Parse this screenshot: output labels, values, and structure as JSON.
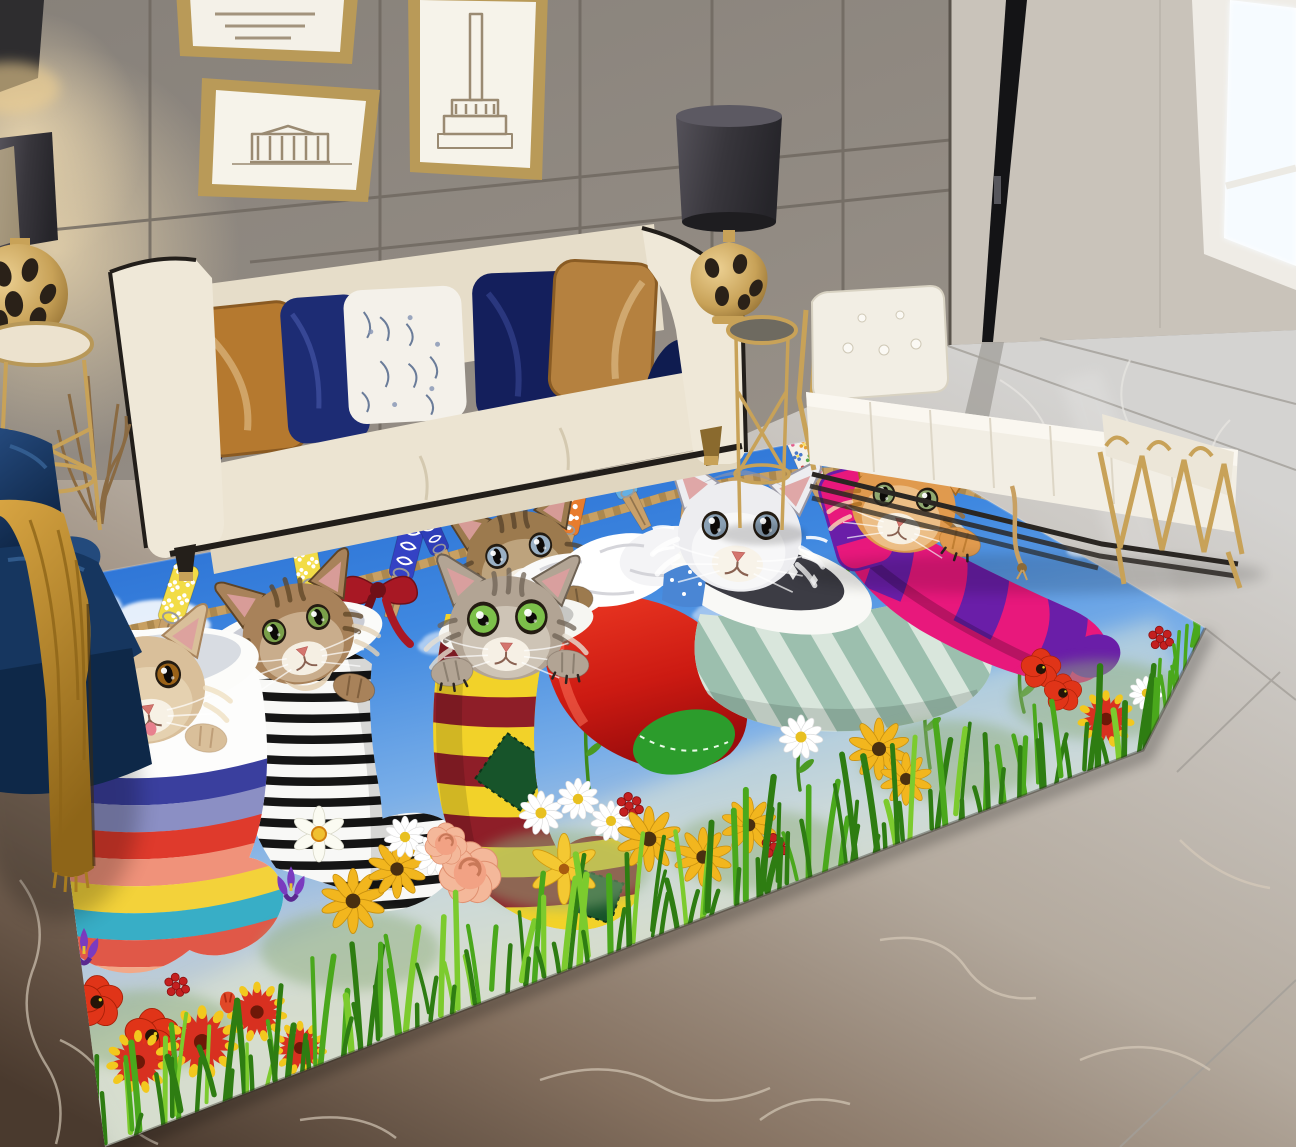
{
  "scene": {
    "label": "Living room product photo: colorful area rug printed with six kittens peeking from stockings hung on a clothesline above a flower meadow; cream sofa with pillows, navy armchair with mustard throw, white daybed bench with gold legs, gold side tables with dark drum lamps, gray panel wall with gold picture frames, bright window, two-tone marble floor",
    "domain": "Natural-Image"
  },
  "palette": {
    "wall": "#8e8780",
    "wallSeam": "#6e675f",
    "wallRight": "#c9c3ba",
    "window": "#fdfdfa",
    "gold": "#c8a258",
    "goldDark": "#8a6a2e",
    "sofaCream": "#efe8d8",
    "sofaCream2": "#e6ddc9",
    "trim": "#221e1a",
    "pillowCaramel": "#b5792f",
    "pillowNavy": "#18266e",
    "benchWhite": "#f2eee4",
    "chairNavy": "#16365f",
    "throwMustard": "#c08b2c",
    "marbleLight": "#cecdca",
    "marbleBrown": "#6b5847",
    "marbleDark": "#3f3128",
    "skyTop": "#1a5ecb",
    "skyLow": "#ccd2c6",
    "rope": "#c8a062",
    "ropeDark": "#8a6a38",
    "grassDark": "#2e7d12",
    "grassMid": "#4aa81c",
    "grassLight": "#7ccb2e"
  },
  "rug": {
    "outline": [
      [
        32,
        585
      ],
      [
        868,
        430
      ],
      [
        1205,
        628
      ],
      [
        1143,
        750
      ],
      [
        105,
        1147
      ]
    ],
    "clouds": [
      [
        160,
        618,
        46,
        0.95
      ],
      [
        300,
        482,
        40,
        0.9
      ],
      [
        368,
        516,
        26,
        0.85
      ],
      [
        532,
        572,
        34,
        1
      ],
      [
        645,
        458,
        48,
        0.9
      ],
      [
        770,
        562,
        20,
        0.8
      ],
      [
        988,
        444,
        44,
        0.9
      ],
      [
        1064,
        465,
        26,
        0.85
      ],
      [
        205,
        702,
        24,
        0.8
      ],
      [
        98,
        602,
        22,
        0.8
      ],
      [
        452,
        642,
        30,
        0.6
      ],
      [
        722,
        612,
        26,
        0.5
      ],
      [
        908,
        560,
        18,
        0.6
      ],
      [
        1092,
        548,
        22,
        0.7
      ]
    ],
    "pins": [
      {
        "x": 172,
        "y": 614,
        "rot": 18,
        "s": 1,
        "color": "#f2dc46",
        "pattern": "floral-white"
      },
      {
        "x": 310,
        "y": 580,
        "rot": -10,
        "s": 0.95,
        "color": "#f2dc46",
        "pattern": "floral-white"
      },
      {
        "x": 402,
        "y": 570,
        "rot": 14,
        "s": 0.95,
        "color": "#3442c4",
        "pattern": "swirl-white"
      },
      {
        "x": 438,
        "y": 546,
        "rot": -24,
        "s": 0.78,
        "color": "#2e3eb8",
        "pattern": "swirl-white"
      },
      {
        "x": 568,
        "y": 526,
        "rot": 12,
        "s": 0.9,
        "color": "#e87c2e",
        "pattern": "speckle-white"
      },
      {
        "x": 626,
        "y": 489,
        "rot": -28,
        "s": 0.85,
        "color": "#64b0e4",
        "pattern": "swirl-white"
      },
      {
        "x": 692,
        "y": 479,
        "rot": 10,
        "s": 0.78,
        "color": "#3850c8",
        "pattern": "diamond-white"
      },
      {
        "x": 812,
        "y": 474,
        "rot": -24,
        "s": 0.82,
        "color": "#f4f1ea",
        "pattern": "floral-multi"
      },
      {
        "x": 884,
        "y": 494,
        "rot": 6,
        "s": 0.68,
        "color": "#f0cdd8",
        "pattern": "floral-multi"
      }
    ],
    "bow": {
      "x": 378,
      "y": 588,
      "color": "#a81824",
      "dark": "#701018"
    },
    "rainbow": [
      "#3a3f9e",
      "#8b8fc4",
      "#df3a2c",
      "#f0927a",
      "#f3d23a",
      "#38aec6",
      "#e05848",
      "#f2a888",
      "#f3d23a"
    ],
    "ymColors": [
      "#f2d229",
      "#8e1e28"
    ],
    "sageStripe": "#9cbfae",
    "sageBase": "#d9e6dc",
    "pinkTube": {
      "base": "#e8187c",
      "ring": "#6a1ea8"
    },
    "santaRed": [
      "#e83020",
      "#a80e0e"
    ],
    "santaToe": "#2c9c2c",
    "cats": [
      {
        "x": 145,
        "y": 688,
        "r": 62,
        "rot": -8,
        "fur": "#d9bf9a",
        "light": "#efe0c2",
        "dark": "#a8845c",
        "eye": "#9a6218",
        "tongue": true,
        "paws": [
          [
            78,
            744,
            -14
          ],
          [
            206,
            738,
            10
          ]
        ],
        "pawClaws": false
      },
      {
        "x": 298,
        "y": 632,
        "r": 58,
        "rot": -14,
        "fur": "#a8825a",
        "light": "#e4d2b6",
        "dark": "#5e4426",
        "eye": "#7aa04a",
        "tabby": true,
        "chest": true,
        "paws": [
          [
            354,
            688,
            14
          ]
        ]
      },
      {
        "x": 520,
        "y": 558,
        "r": 56,
        "rot": -10,
        "fur": "#9c7a4e",
        "light": "#d8c4a4",
        "dark": "#55412a",
        "eye": "#9ab0c4",
        "tabby": true
      },
      {
        "x": 507,
        "y": 626,
        "r": 60,
        "rot": 2,
        "fur": "#b2a494",
        "light": "#e6ded2",
        "dark": "#6e6254",
        "eye": "#7cc04a",
        "tabby": true,
        "bigEyes": true,
        "paws": [
          [
            452,
            672,
            -8
          ],
          [
            568,
            664,
            6
          ]
        ],
        "pawClaws": true
      },
      {
        "x": 740,
        "y": 534,
        "r": 64,
        "rot": 5,
        "fur": "#ededf0",
        "light": "#ffffff",
        "dark": "#9a98a4",
        "eye": "#8aa0b4",
        "fluffy": true
      },
      {
        "x": 904,
        "y": 504,
        "r": 54,
        "rot": 12,
        "fur": "#e09a4e",
        "light": "#f6ddb5",
        "dark": "#a86a1e",
        "eye": "#90a870",
        "tabby": true,
        "paws": [
          [
            960,
            542,
            18
          ]
        ],
        "pawClaws": true
      }
    ],
    "flowers": [
      [
        "pinkcluster",
        40,
        656,
        0.8
      ],
      [
        "pinkcluster",
        28,
        692,
        0.7
      ],
      [
        "iris",
        84,
        952,
        1.0
      ],
      [
        "poppy",
        97,
        1002,
        1.1
      ],
      [
        "poppy",
        152,
        1036,
        1.15
      ],
      [
        "redcluster",
        176,
        986,
        0.8
      ],
      [
        "gaillardia",
        202,
        1042,
        1.15
      ],
      [
        "gaillardia",
        257,
        1012,
        0.95
      ],
      [
        "gaillardia",
        138,
        1062,
        1.0
      ],
      [
        "gaillardia",
        300,
        1048,
        0.85
      ],
      [
        "iris",
        291,
        889,
        0.95
      ],
      [
        "daffodil",
        319,
        834,
        1.0
      ],
      [
        "susan",
        353,
        901,
        1.05
      ],
      [
        "susan",
        397,
        869,
        0.95
      ],
      [
        "daisy",
        405,
        837,
        0.8
      ],
      [
        "daisy",
        435,
        855,
        0.8
      ],
      [
        "rose",
        470,
        873,
        1.25
      ],
      [
        "rose",
        446,
        844,
        0.85
      ],
      [
        "daisy",
        541,
        813,
        0.85
      ],
      [
        "daisy",
        578,
        799,
        0.8
      ],
      [
        "daisy",
        611,
        821,
        0.78
      ],
      [
        "daylily",
        564,
        869,
        1.05
      ],
      [
        "redcluster",
        629,
        806,
        0.85
      ],
      [
        "susan",
        649,
        839,
        1.05
      ],
      [
        "susan",
        703,
        857,
        0.95
      ],
      [
        "susan",
        749,
        825,
        0.9
      ],
      [
        "redcluster",
        774,
        847,
        0.85
      ],
      [
        "daisy",
        801,
        737,
        0.85
      ],
      [
        "susan",
        879,
        749,
        1.0
      ],
      [
        "susan",
        906,
        779,
        0.85
      ],
      [
        "poppy",
        1041,
        669,
        0.85
      ],
      [
        "poppy",
        1063,
        693,
        0.8
      ],
      [
        "redcluster",
        1160,
        639,
        0.8
      ],
      [
        "gaillardia",
        1106,
        719,
        0.9
      ],
      [
        "daisy",
        1146,
        693,
        0.65
      ],
      [
        "tulip",
        228,
        1006,
        0.9
      ]
    ],
    "stems": [
      [
        332,
        868,
        326,
        708
      ],
      [
        590,
        798,
        586,
        700
      ],
      [
        853,
        700,
        848,
        562
      ],
      [
        950,
        688,
        944,
        548
      ],
      [
        930,
        768,
        924,
        680
      ],
      [
        800,
        790,
        800,
        742
      ],
      [
        1024,
        712,
        1020,
        668
      ]
    ],
    "grass": {
      "n": 88,
      "nEdge": 14
    }
  }
}
